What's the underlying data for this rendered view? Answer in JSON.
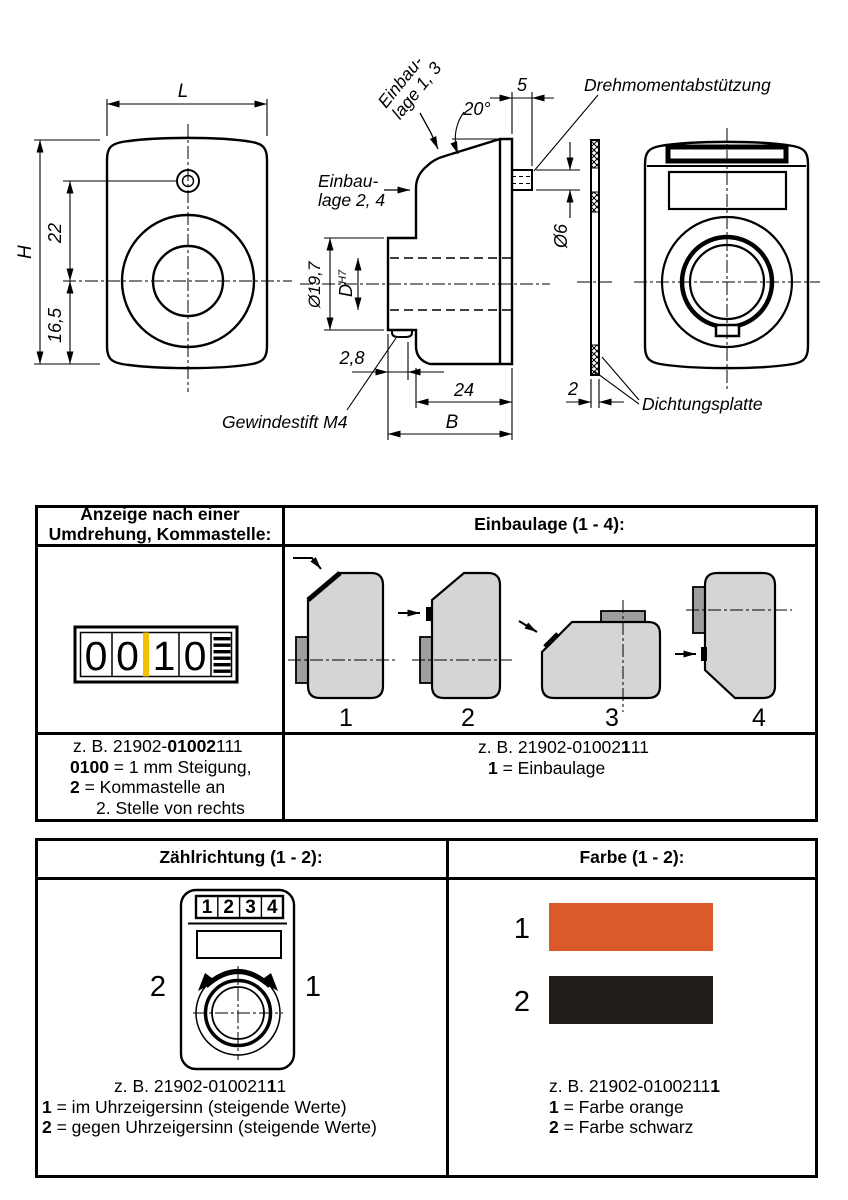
{
  "drawing": {
    "dim_L": "L",
    "dim_H": "H",
    "dim_22": "22",
    "dim_16_5": "16,5",
    "einbaulage_1_3_line1": "Einbau-",
    "einbaulage_1_3_line2": "lage 1, 3",
    "einbaulage_2_4_line1": "Einbau-",
    "einbaulage_2_4_line2": "lage 2, 4",
    "angle_20": "20°",
    "dim_5": "5",
    "label_drehmomentabstuetzung": "Drehmomentabstützung",
    "dia_6": "Ø6",
    "dia_19_7": "Ø19,7",
    "bore_D": "D",
    "bore_tol": "H7",
    "dim_2_8": "2,8",
    "dim_24": "24",
    "dim_B": "B",
    "label_gewindestift": "Gewindestift M4",
    "dim_2": "2",
    "label_dichtungsplatte": "Dichtungsplatte"
  },
  "anzeige_table": {
    "header_left_line1": "Anzeige nach einer",
    "header_left_line2": "Umdrehung, Kommastelle:",
    "header_right": "Einbaulage (1 - 4):",
    "counter": {
      "digits": [
        "0",
        "0",
        "1",
        "0"
      ],
      "comma_color": "#F2C100"
    },
    "positions": [
      "1",
      "2",
      "3",
      "4"
    ],
    "footer_left": {
      "line1_pre": "z. B. 21902-",
      "line1_bold": "01002",
      "line1_post": "111",
      "line2_bold": "0100",
      "line2_post": " = 1 mm Steigung,",
      "line3_bold": "2",
      "line3_post": " = Kommastelle an",
      "line4": "2. Stelle von rechts"
    },
    "footer_right": {
      "line1_pre": "z. B. 21902-01002",
      "line1_bold": "1",
      "line1_post": "11",
      "line2_bold": "1",
      "line2_post": " = Einbaulage"
    }
  },
  "options_table": {
    "header_left": "Zählrichtung (1 - 2):",
    "header_right": "Farbe (1 - 2):",
    "dial": {
      "digits": [
        "1",
        "2",
        "3",
        "4"
      ],
      "label_ccw": "2",
      "label_cw": "1"
    },
    "colors": [
      {
        "num": "1",
        "hex": "#DB5A2B"
      },
      {
        "num": "2",
        "hex": "#201D1A"
      }
    ],
    "footer_left": {
      "line1_pre": "z. B.  21902-010021",
      "line1_bold": "1",
      "line1_post": "1",
      "line2_bold": "1",
      "line2_post": " = im Uhrzeigersinn (steigende Werte)",
      "line3_bold": "2",
      "line3_post": " = gegen Uhrzeigersinn (steigende Werte)"
    },
    "footer_right": {
      "line1_pre": "z. B. 21902-0100211",
      "line1_bold": "1",
      "line1_post": "",
      "line2_bold": "1",
      "line2_post": " = Farbe orange",
      "line3_bold": "2",
      "line3_post": " = Farbe schwarz"
    }
  }
}
